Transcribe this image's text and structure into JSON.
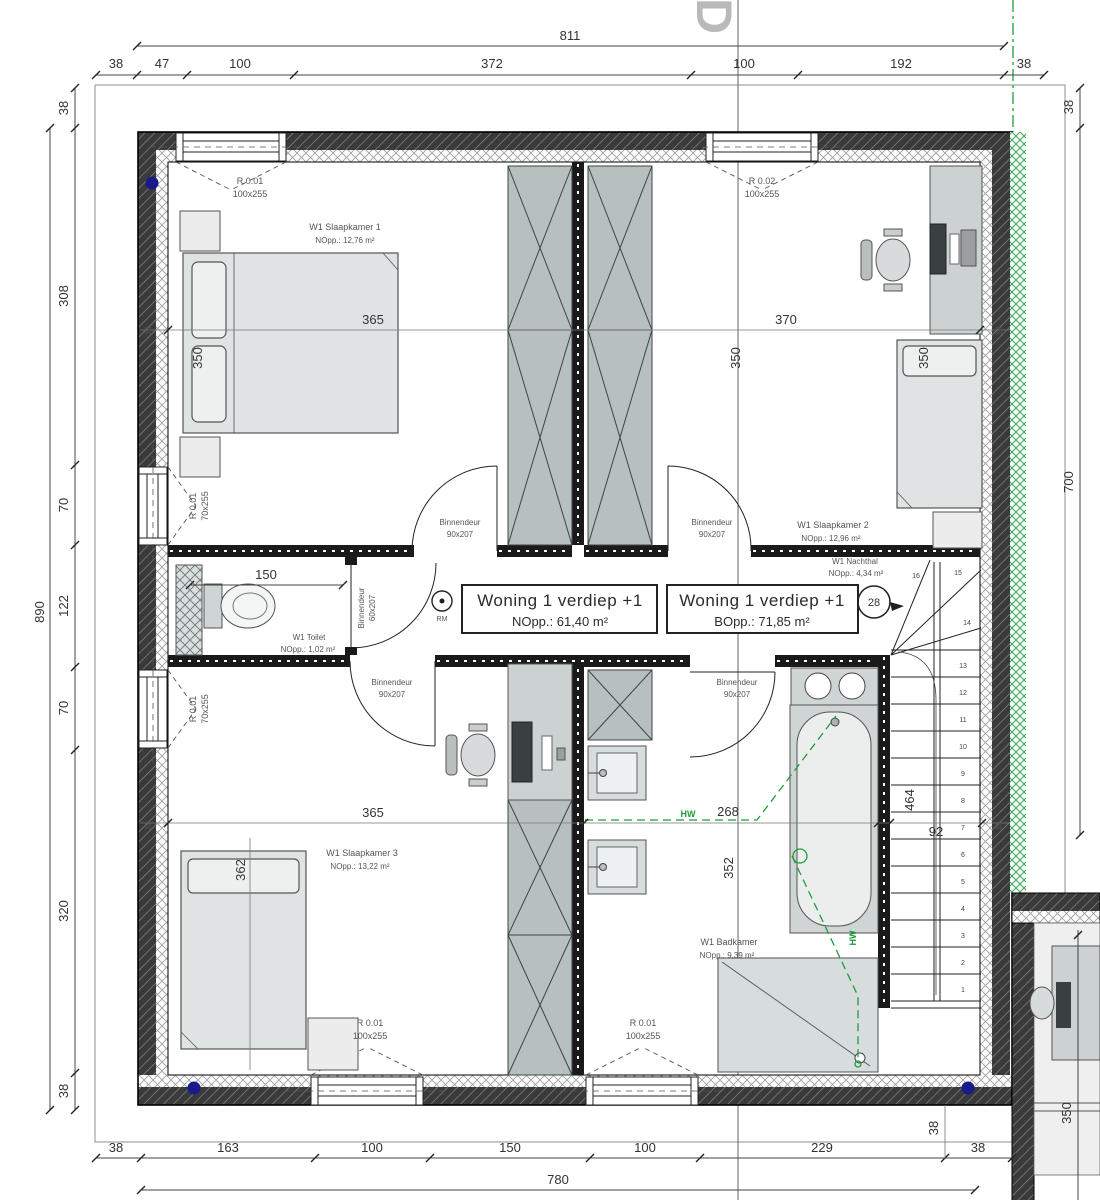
{
  "watermark": "D",
  "dims": {
    "top_total": "811",
    "top": [
      "38",
      "47",
      "100",
      "372",
      "100",
      "192",
      "38"
    ],
    "left_total": "890",
    "left": [
      "38",
      "308",
      "70",
      "122",
      "70",
      "320",
      "38"
    ],
    "right_wall": "38",
    "right_total": "700",
    "bottom": [
      "38",
      "163",
      "100",
      "150",
      "100",
      "229",
      "38"
    ],
    "bottom_total": "780",
    "bottom_stair_wall": "38",
    "adjacent_room": "350",
    "wall_tick": "38",
    "interior": {
      "room1_w": "365",
      "room1_d": "350",
      "room2_w": "370",
      "room2_d": "350",
      "room2_d2": "350",
      "toilet_w": "150",
      "room3_w": "365",
      "room3_d": "362",
      "bath_w": "268",
      "bath_d": "352",
      "stair_w": "92",
      "stair_l": "464"
    }
  },
  "windows": {
    "tl": {
      "ref": "R 0.01",
      "size": "100x255"
    },
    "tr": {
      "ref": "R 0.02",
      "size": "100x255"
    },
    "left": {
      "ref": "R 0.01",
      "size": "70x255"
    },
    "b1": {
      "ref": "R 0.01",
      "size": "100x255"
    },
    "b2": {
      "ref": "R 0.01",
      "size": "100x255"
    }
  },
  "rooms": {
    "sk1": {
      "name": "W1  Slaapkamer 1",
      "area": "NOpp.: 12,76 m²"
    },
    "sk2": {
      "name": "W1  Slaapkamer 2",
      "area": "NOpp.: 12,96 m²"
    },
    "hal": {
      "name": "W1  Nachthal",
      "area": "NOpp.: 4,34 m²"
    },
    "toilet": {
      "name": "W1  Toilet",
      "area": "NOpp.: 1,02 m²"
    },
    "sk3": {
      "name": "W1  Slaapkamer 3",
      "area": "NOpp.: 13,22 m²"
    },
    "bath": {
      "name": "W1  Badkamer",
      "area": "NOpp.: 9,39 m²"
    }
  },
  "doors": {
    "d90": {
      "line1": "Binnendeur",
      "line2": "90x207"
    },
    "d60": {
      "line1": "Binnendeur",
      "line2": "60x207"
    }
  },
  "info": [
    {
      "title": "Woning 1  verdiep +1",
      "area": "NOpp.:   61,40 m²"
    },
    {
      "title": "Woning 1  verdiep +1",
      "area": "BOpp.:   71,85 m²"
    }
  ],
  "stairs": {
    "circle_label": "28",
    "steps": [
      "1",
      "2",
      "3",
      "4",
      "5",
      "6",
      "7",
      "8",
      "9",
      "10",
      "11",
      "12",
      "13",
      "14",
      "15",
      "16"
    ]
  },
  "symbols": {
    "smoke": "RM",
    "hw1": "HW",
    "hw2": "HW"
  },
  "colors": {
    "wall_dark": "#333333",
    "insulation": "#fdfdfd",
    "green": "#1f9d3a",
    "blue_dot": "#1a1a8a",
    "furniture": "#d7dbdb",
    "wardrobe": "#b7bfbf"
  }
}
